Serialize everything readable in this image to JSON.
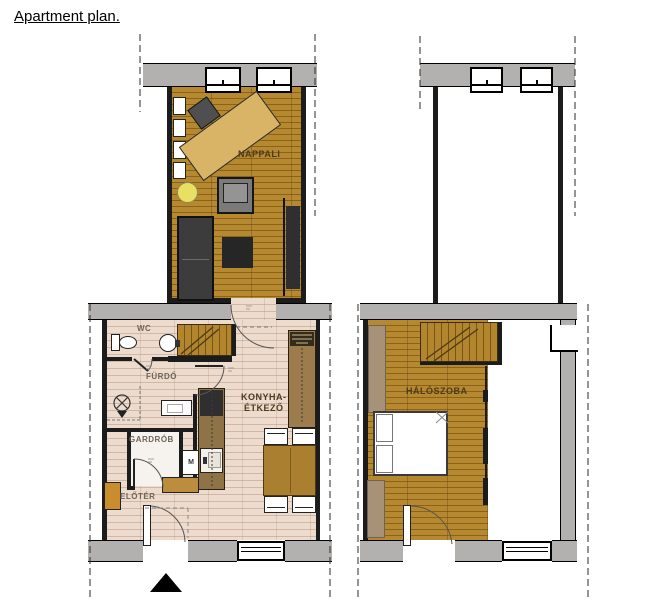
{
  "title": "Apartment plan.",
  "rooms": {
    "nappali": "NAPPALI",
    "wc": "WC",
    "furdo": "FÜRDŐ",
    "konyha_line1": "KONYHA-",
    "konyha_line2": "ÉTKEZŐ",
    "gardrob": "GARDRÓB",
    "eloter": "ELŐTÉR",
    "haloszoba": "HÁLÓSZOBA"
  },
  "appliances": {
    "washing_machine": "M"
  },
  "colors": {
    "wall_gray": "#b2b1b0",
    "wood_floor": "#b6882f",
    "tile_floor": "#eddcce",
    "desk_wood": "#d9b466",
    "accent_yellow": "#e9df63",
    "cabinet_brown": "#9c7c4c",
    "table_brown": "#aa7f2f"
  }
}
